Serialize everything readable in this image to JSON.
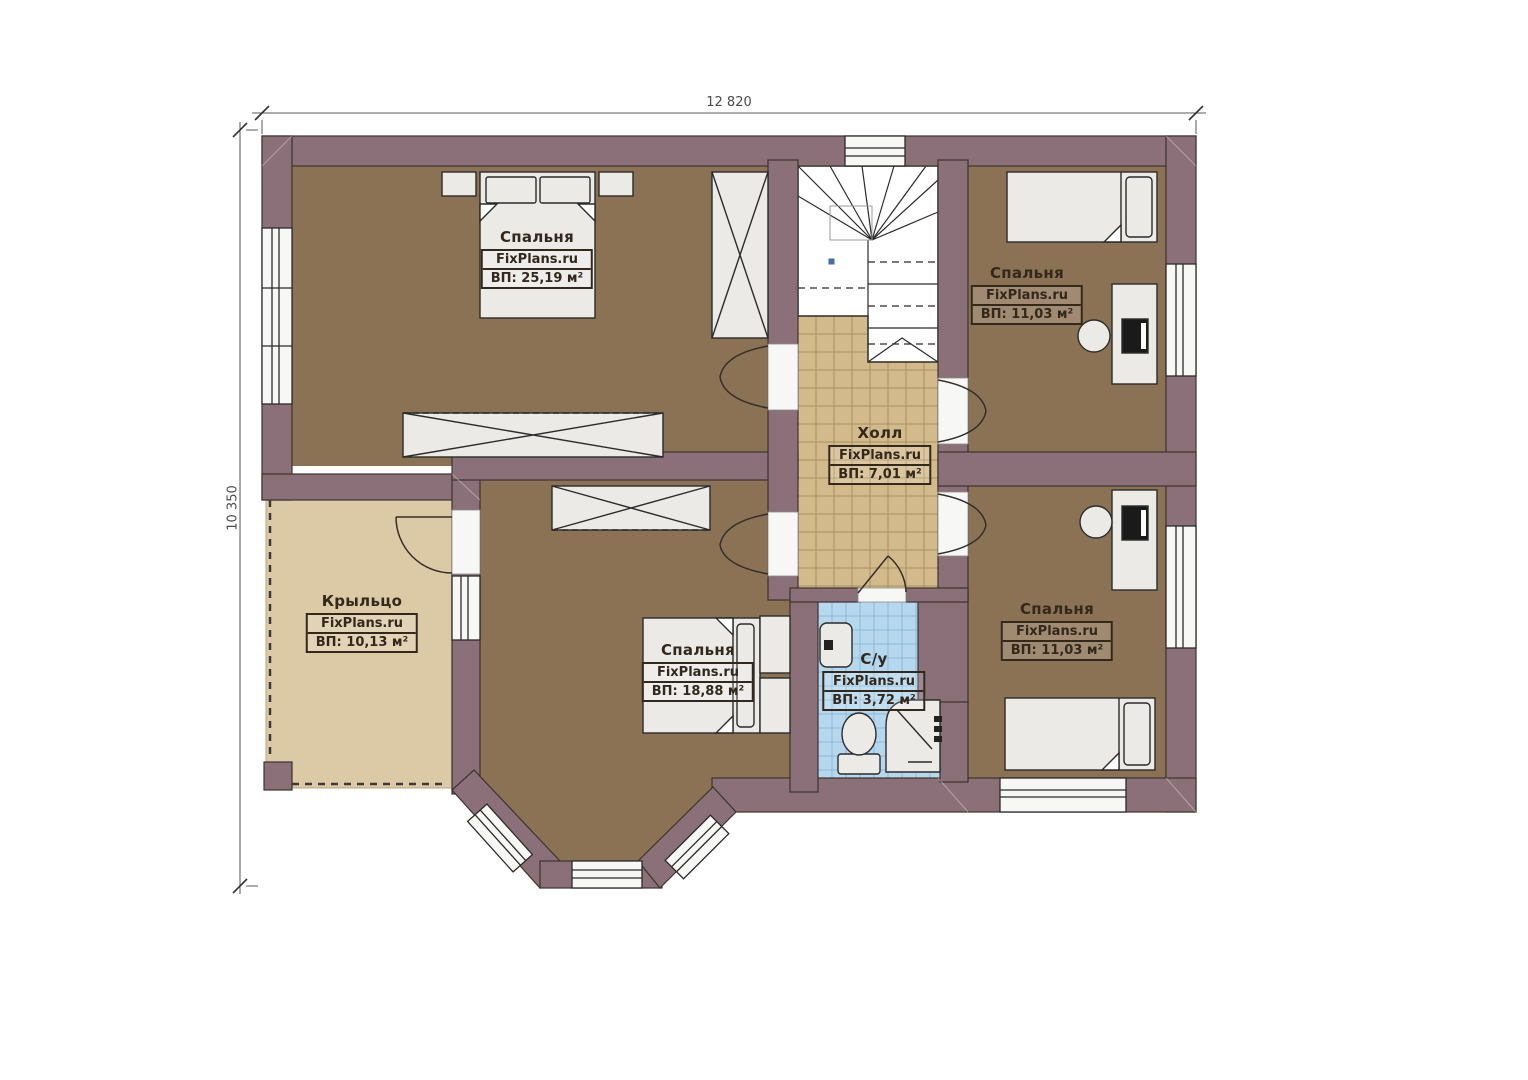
{
  "brand": "FixPlans.ru",
  "dimensions": {
    "top": "12 820",
    "left": "10 350"
  },
  "rooms": {
    "bedroom_tl": {
      "name": "Спальня",
      "brand": "FixPlans.ru",
      "area": "ВП: 25,19 м²"
    },
    "bedroom_tr": {
      "name": "Спальня",
      "brand": "FixPlans.ru",
      "area": "ВП: 11,03 м²"
    },
    "hall": {
      "name": "Холл",
      "brand": "FixPlans.ru",
      "area": "ВП: 7,01 м²"
    },
    "porch": {
      "name": "Крыльцо",
      "brand": "FixPlans.ru",
      "area": "ВП: 10,13 м²"
    },
    "bedroom_bc": {
      "name": "Спальня",
      "brand": "FixPlans.ru",
      "area": "ВП: 18,88 м²"
    },
    "bathroom": {
      "name": "С/у",
      "brand": "FixPlans.ru",
      "area": "ВП: 3,72 м²"
    },
    "bedroom_br": {
      "name": "Спальня",
      "brand": "FixPlans.ru",
      "area": "ВП: 11,03 м²"
    }
  },
  "colors": {
    "wall": "#8b7079",
    "bedroom_floor": "#8c7254",
    "hall_floor": "#d3ba8c",
    "bath_floor": "#b5d8ee",
    "porch_floor": "#dcc9a6"
  }
}
